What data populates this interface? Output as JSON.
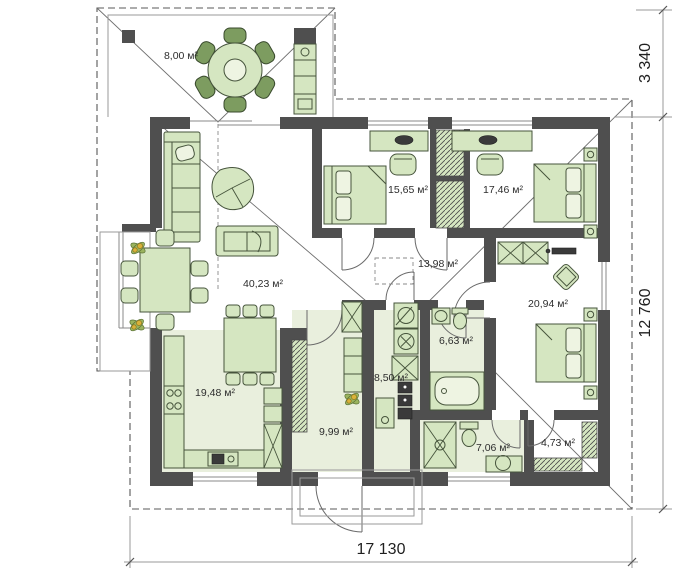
{
  "plan": {
    "title": "single-storey house floor plan",
    "rooms": [
      {
        "id": "terrace",
        "area": "8,00 м²"
      },
      {
        "id": "bedroom-1",
        "area": "15,65 м²"
      },
      {
        "id": "bedroom-2",
        "area": "17,46 м²"
      },
      {
        "id": "living-room",
        "area": "40,23 м²"
      },
      {
        "id": "corridor",
        "area": "13,98 м²"
      },
      {
        "id": "bedroom-3",
        "area": "20,94 м²"
      },
      {
        "id": "kitchen",
        "area": "19,48 м²"
      },
      {
        "id": "hallway",
        "area": "9,99 м²"
      },
      {
        "id": "utility",
        "area": "8,50 м²"
      },
      {
        "id": "bathroom",
        "area": "6,63 м²"
      },
      {
        "id": "bathroom-2",
        "area": "7,06 м²"
      },
      {
        "id": "wardrobe",
        "area": "4,73 м²"
      }
    ],
    "dimensions": {
      "overall_width": "17 130",
      "overall_depth": "12 760",
      "terrace_depth": "3 340"
    },
    "colors": {
      "wall": "#4f4f4f",
      "furniture": "#d5e6c1",
      "furniture_dark": "#7d9c60",
      "floor_tint": "#e9efdd",
      "text": "#2d2d2d"
    }
  }
}
